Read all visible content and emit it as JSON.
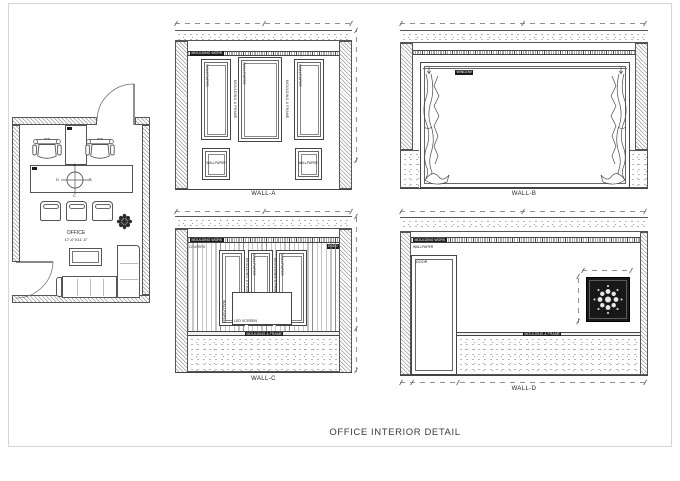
{
  "title": "OFFICE INTERIOR DETAIL",
  "floor_plan": {
    "room_label": "OFFICE",
    "room_size": "17'-0\"X11'-0\"",
    "compass": {
      "top": "A",
      "right": "B",
      "bottom": "C",
      "left": "D"
    }
  },
  "walls": {
    "a": {
      "label": "WALL-A",
      "moulding_band": "MOULDING WORK",
      "panel_wallpaper": "WALLPAPER",
      "panel_frame": "MOULDING & FRAME"
    },
    "b": {
      "label": "WALL-B",
      "window_label": "WINDOW"
    },
    "c": {
      "label": "WALL-C",
      "moulding_band": "MOULDING WORK",
      "louvers": "LOUVERS",
      "dado": "DADO",
      "led_screen": "LED SCREEN",
      "ledge": "MOULDING & FRAME",
      "wallpaper": "WALLPAPER",
      "panel_frame": "MOULDING & FRAME",
      "panel_wallpaper": "WALLPAPER"
    },
    "d": {
      "label": "WALL-D",
      "moulding_band": "MOULDING WORK",
      "wallpaper_top": "WALLPAPER",
      "door_label": "DOOR",
      "ledge": "MOULDING & FRAME",
      "wallpaper_bottom": "WALLPAPER"
    }
  }
}
